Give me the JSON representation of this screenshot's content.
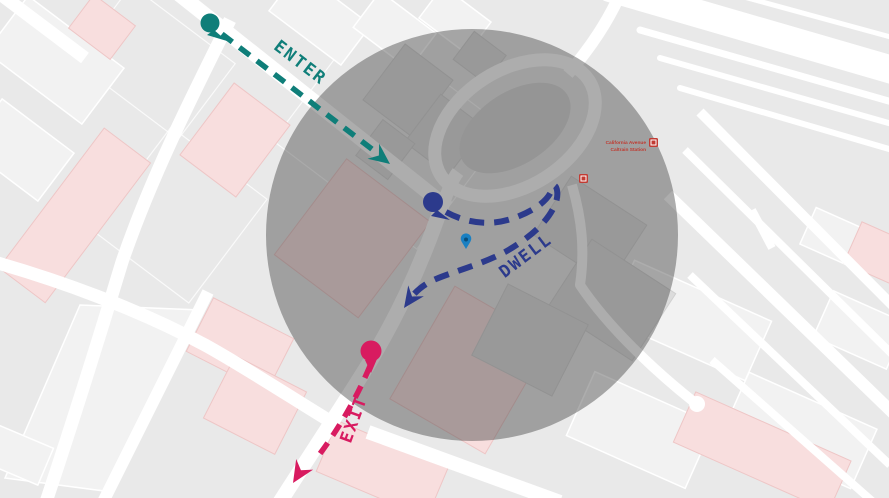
{
  "map": {
    "background_color": "#e9e9e9",
    "road_color": "#ffffff",
    "building_gray_color": "#dcdcdc",
    "building_pink_color": "#f8dede",
    "light_block_color": "#f2f2f2",
    "geofence": {
      "shape": "circle",
      "fill": "rgba(60,60,60,0.42)"
    },
    "station": {
      "label_line1": "California Avenue",
      "label_line2": "Caltrain Station",
      "label_color": "#bf3a30",
      "icon_name": "transit-station-icon",
      "icon_color": "#c23b33"
    }
  },
  "annotations": {
    "enter": {
      "label": "ENTER",
      "color": "#0f7e79"
    },
    "dwell": {
      "label": "DWELL",
      "color": "#2c3a8c"
    },
    "exit": {
      "label": "EXIT",
      "color": "#d81b60"
    },
    "location_pin": {
      "color": "#1a80c2",
      "inner_color": "#0b4e7a"
    }
  }
}
